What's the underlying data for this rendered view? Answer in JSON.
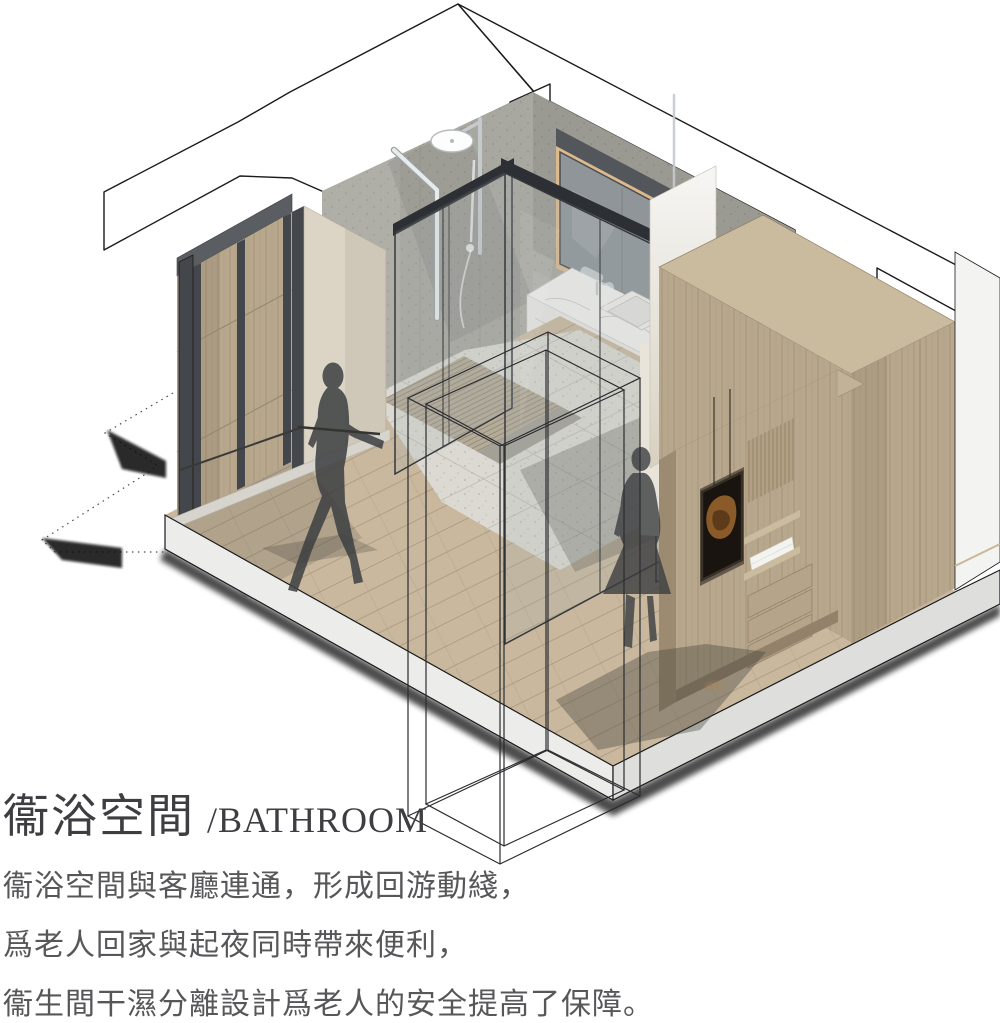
{
  "title": {
    "zh": "衞浴空間",
    "en": "/BATHROOM"
  },
  "description": {
    "line1": "衞浴空間與客廳連通，形成回游動綫，",
    "line2": "爲老人回家與起夜同時帶來便利，",
    "line3": "衞生間干濕分離設計爲老人的安全提高了保障。"
  },
  "scene": {
    "type": "isometric-interior-rendering",
    "room": "bathroom with dry-wet separation, connected to living room",
    "figures": [
      "walking-person-silhouette",
      "standing-person-silhouette"
    ]
  },
  "palette": {
    "band": "#ffffff",
    "outline": "#1b1b1b",
    "terrazzo": "#a9a8a0",
    "terrazzoShade": "#8e8d85",
    "wood": "#b7a78c",
    "woodDark": "#a3937a",
    "woodTop": "#cabb9f",
    "floor": "#c9b89e",
    "floorLine": "#a8977e",
    "tile": "#dbd9d1",
    "tileLine": "#c2c0b8",
    "grate": "#b5ab99",
    "beige": "#dcd5c5",
    "marble": "#f2f1ed",
    "charcoal": "#43464a",
    "frameDark": "#2c2f33",
    "glassLine": "#35383c",
    "chrome": "#c5cacd",
    "whiteWall": "#f3f3f1",
    "slabLight": "#ececea",
    "slabDark": "#dededc",
    "silhouette": "#3c3e41",
    "shadow": "#3c3c36",
    "led": "#dcba8e",
    "ledBright": "#e0ad72",
    "titleColor": "#3e3e42",
    "bodyColor": "#57575a"
  }
}
